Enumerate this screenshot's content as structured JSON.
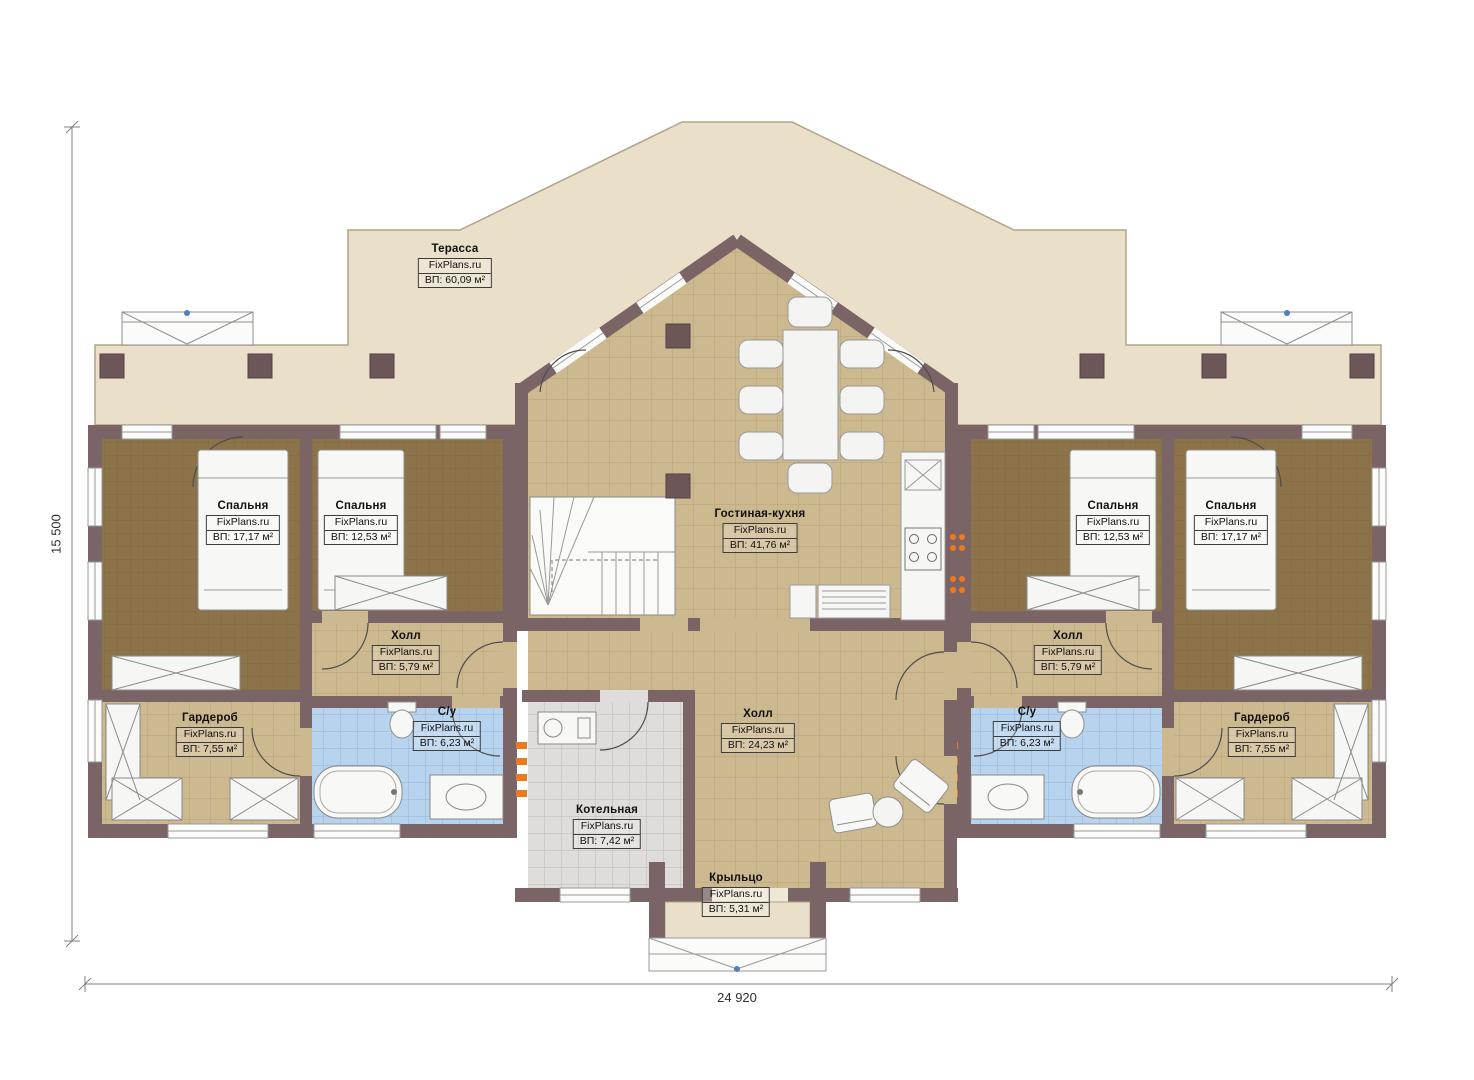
{
  "dimensions": {
    "left": "15 500",
    "bottom": "24 920"
  },
  "colors": {
    "wall": "#7a6466",
    "terrace": "#eadfc9",
    "floor_tan": "#cdb98f",
    "carpet_brown": "#8c734a",
    "tile_blue": "#b7d3ee",
    "tile_gray": "#dfdddb",
    "radiator_orange": "#ee7a20",
    "marker_blue": "#4d7ebf"
  },
  "rooms": {
    "terrace": {
      "name": "Терасса",
      "brand": "FixPlans.ru",
      "area": "ВП: 60,09 м²"
    },
    "bedroom_left_1": {
      "name": "Спальня",
      "brand": "FixPlans.ru",
      "area": "ВП: 17,17 м²"
    },
    "bedroom_left_2": {
      "name": "Спальня",
      "brand": "FixPlans.ru",
      "area": "ВП: 12,53 м²"
    },
    "living_kitchen": {
      "name": "Гостиная-кухня",
      "brand": "FixPlans.ru",
      "area": "ВП: 41,76 м²"
    },
    "hall_left": {
      "name": "Холл",
      "brand": "FixPlans.ru",
      "area": "ВП: 5,79 м²"
    },
    "bathroom_left": {
      "name": "С/у",
      "brand": "FixPlans.ru",
      "area": "ВП: 6,23 м²"
    },
    "wardrobe_left": {
      "name": "Гардероб",
      "brand": "FixPlans.ru",
      "area": "ВП: 7,55 м²"
    },
    "hall_center": {
      "name": "Холл",
      "brand": "FixPlans.ru",
      "area": "ВП: 24,23 м²"
    },
    "boiler_room": {
      "name": "Котельная",
      "brand": "FixPlans.ru",
      "area": "ВП: 7,42 м²"
    },
    "porch": {
      "name": "Крыльцо",
      "brand": "FixPlans.ru",
      "area": "ВП: 5,31 м²"
    },
    "hall_right": {
      "name": "Холл",
      "brand": "FixPlans.ru",
      "area": "ВП: 5,79 м²"
    },
    "bathroom_right": {
      "name": "С/у",
      "brand": "FixPlans.ru",
      "area": "ВП: 6,23 м²"
    },
    "wardrobe_right": {
      "name": "Гардероб",
      "brand": "FixPlans.ru",
      "area": "ВП: 7,55 м²"
    },
    "bedroom_right_1": {
      "name": "Спальня",
      "brand": "FixPlans.ru",
      "area": "ВП: 12,53 м²"
    },
    "bedroom_right_2": {
      "name": "Спальня",
      "brand": "FixPlans.ru",
      "area": "ВП: 17,17 м²"
    }
  }
}
